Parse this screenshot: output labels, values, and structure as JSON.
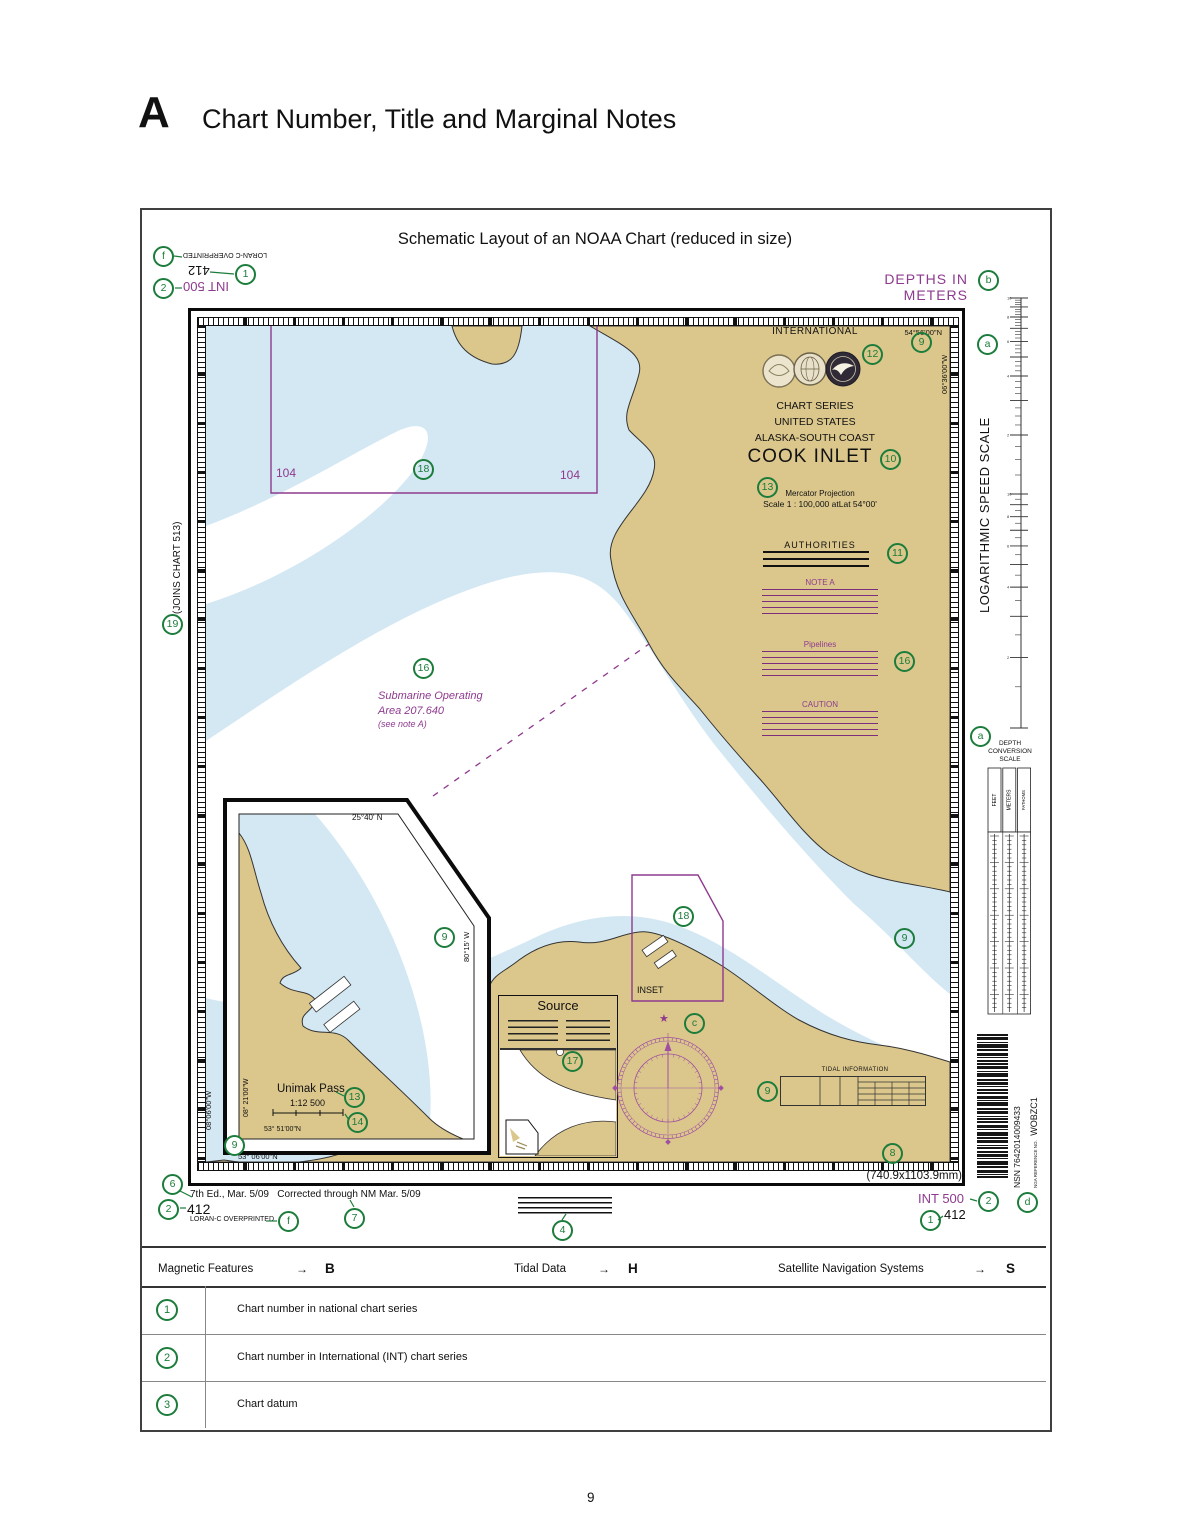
{
  "header": {
    "letter": "A",
    "title": "Chart Number, Title and Marginal Notes"
  },
  "figure": {
    "caption": "Schematic Layout of an NOAA Chart (reduced in size)",
    "depths_note": "DEPTHS IN METERS",
    "dimensions": "(740.9x1103.9mm)"
  },
  "margins": {
    "loran": "LORAN-C OVERPRINTED",
    "national_number": "412",
    "int_number": "INT 500",
    "joins": "(JOINS CHART 513)",
    "edition": "7th Ed., Mar. 5/09",
    "corrected": "Corrected through NM Mar. 5/09",
    "log_speed_scale": "LOGARITHMIC SPEED SCALE",
    "depth_scale_line1": "DEPTH",
    "depth_scale_line2": "CONVERSION",
    "depth_scale_line3": "SCALE",
    "feet": "FEET",
    "meters": "METERS",
    "fathoms": "FATHOMS",
    "nsn": "NSN 7642014009433",
    "nga_label": "NGA REFERENCE NO.",
    "nga_number": "WOBZC1"
  },
  "title_block": {
    "international": "INTERNATIONAL",
    "series": "CHART SERIES",
    "nation": "UNITED STATES",
    "region": "ALASKA-SOUTH COAST",
    "name": "COOK INLET",
    "projection": "Mercator Projection",
    "scale": "Scale 1 : 100,000 atLat 54°00'",
    "authorities": "AUTHORITIES",
    "note_a": "NOTE A",
    "pipelines": "Pipelines",
    "caution": "CAUTION"
  },
  "map": {
    "lat_ne": "54°56'00\"N",
    "lon_ne": "06°36'00\"W",
    "lat_sw": "53° 06'00\"N",
    "lon_sw": "08°06'00\"W",
    "boundary_number": "104",
    "submarine_line1": "Submarine Operating",
    "submarine_line2": "Area  207.640",
    "submarine_line3": "(see note A)",
    "inset_label": "INSET",
    "source_title": "Source",
    "tidal_title": "TIDAL INFORMATION",
    "compass_star": "★"
  },
  "inset": {
    "lat_top": "25°40' N",
    "lon_right": "80°15' W",
    "name": "Unimak Pass",
    "scale": "1:12 500",
    "lon_left": "08° 21'00\"W",
    "lat_bottom": "53° 51'00\"N"
  },
  "references": {
    "arrow": "→",
    "list": [
      {
        "label": "Magnetic Features",
        "ref": "B"
      },
      {
        "label": "Tidal Data",
        "ref": "H"
      },
      {
        "label": "Satellite Navigation Systems",
        "ref": "S"
      }
    ]
  },
  "items": [
    {
      "num": "1",
      "text": "Chart number in national chart series"
    },
    {
      "num": "2",
      "text": "Chart number in International (INT) chart series"
    },
    {
      "num": "3",
      "text": "Chart datum"
    }
  ],
  "callouts": {
    "f_top": "f",
    "n1_top": "1",
    "n2_top": "2",
    "b": "b",
    "a_speed": "a",
    "n9_ne": "9",
    "n12": "12",
    "n10": "10",
    "n13_title": "13",
    "n11": "11",
    "n19": "19",
    "n18_rect": "18",
    "n16_sub": "16",
    "n16_pipe": "16",
    "a_depth": "a",
    "n9_inset": "9",
    "n9_east": "9",
    "n13_unimak": "13",
    "n14": "14",
    "n9_sw": "9",
    "n18_inset": "18",
    "c_compass": "c",
    "n17": "17",
    "n9_tidal": "9",
    "n8": "8",
    "n6": "6",
    "n2_bl": "2",
    "f_bl": "f",
    "n7": "7",
    "n4": "4",
    "n2_br": "2",
    "n1_br": "1",
    "d": "d"
  },
  "page_number": "9",
  "colors": {
    "purple": "#8e3a8e",
    "green": "#1c7c3b",
    "land": "#dbc78c",
    "water": "#d4e8f3"
  }
}
